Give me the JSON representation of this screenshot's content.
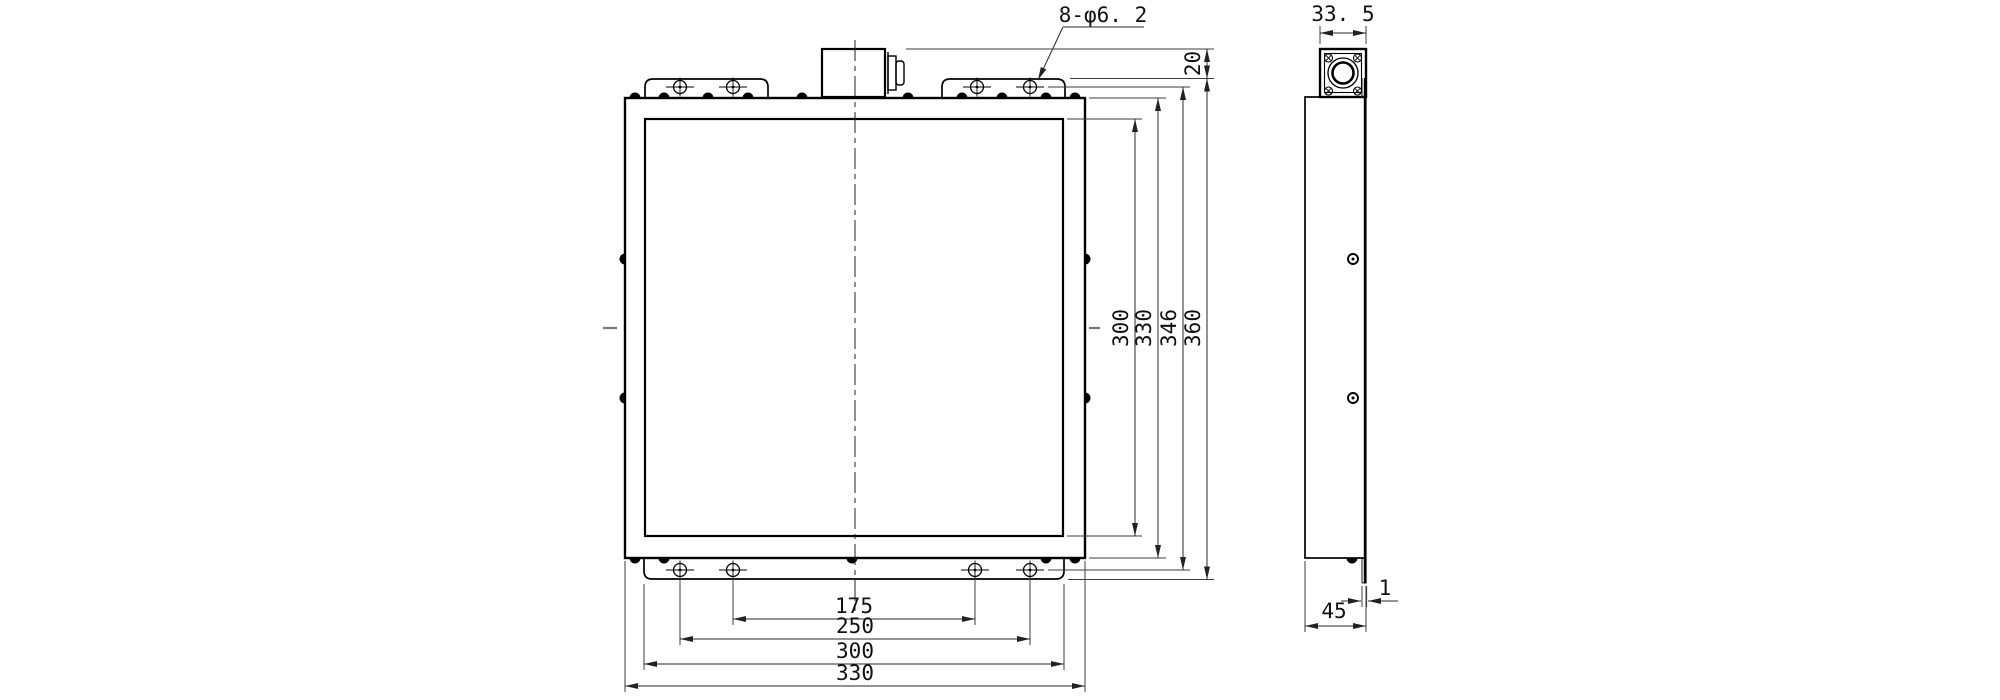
{
  "drawing": {
    "colors": {
      "line": "#000000",
      "background": "#ffffff"
    },
    "dims": {
      "hole_callout": "8-φ6. 2",
      "protrusion": "20",
      "v_mesh": "300",
      "v_frame": "330",
      "v_hole_pitch": "346",
      "v_overall": "360",
      "h_pitch_inner": "175",
      "h_pitch_outer": "250",
      "h_tab": "300",
      "h_frame": "330",
      "conn_width": "33. 5",
      "depth": "45",
      "plate_thickness": "1"
    }
  }
}
